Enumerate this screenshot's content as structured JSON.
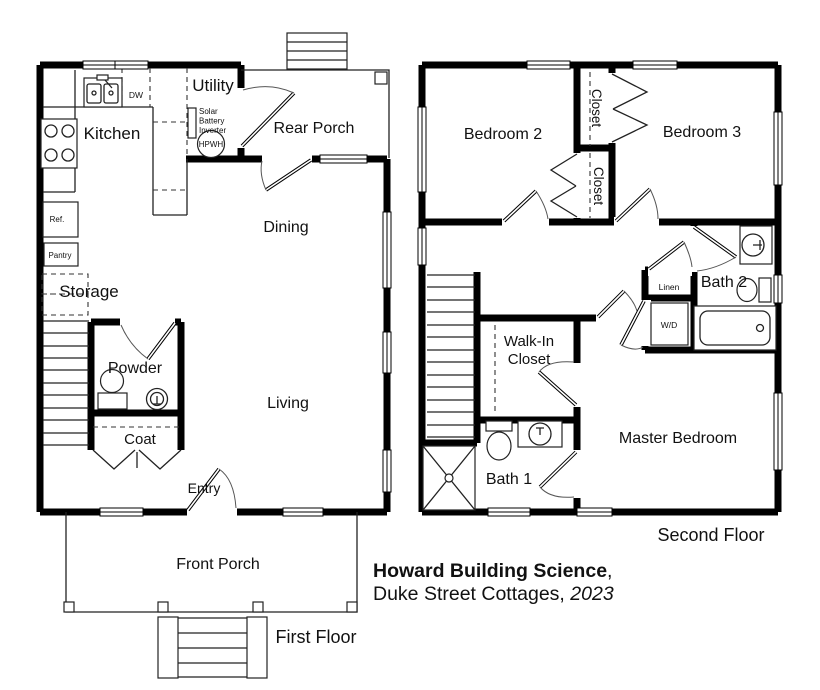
{
  "title_block": {
    "line1_bold": "Howard Building Science",
    "line1_rest": ",",
    "line2": "Duke Street Cottages, ",
    "year": "2023"
  },
  "first_floor": {
    "floor_label": "First Floor",
    "rooms": {
      "kitchen": "Kitchen",
      "utility": "Utility",
      "rear_porch": "Rear Porch",
      "dining": "Dining",
      "living": "Living",
      "storage": "Storage",
      "powder": "Powder",
      "coat": "Coat",
      "entry": "Entry",
      "front_porch": "Front Porch"
    },
    "fixtures": {
      "dw": "DW",
      "ref": "Ref.",
      "pantry": "Pantry",
      "solar_line1": "Solar",
      "solar_line2": "Battery",
      "solar_line3": "Inverter",
      "hpwh": "HPWH"
    }
  },
  "second_floor": {
    "floor_label": "Second Floor",
    "rooms": {
      "bedroom2": "Bedroom 2",
      "bedroom3": "Bedroom 3",
      "closet_bedroom3": "Closet",
      "closet_bedroom2": "Closet",
      "bath2": "Bath 2",
      "linen": "Linen",
      "wd": "W/D",
      "walk_in_line1": "Walk-In",
      "walk_in_line2": "Closet",
      "bath1": "Bath 1",
      "master": "Master Bedroom"
    }
  },
  "colors": {
    "wall": "#000000",
    "thin_line": "#222222",
    "text": "#111111",
    "background": "#ffffff"
  }
}
